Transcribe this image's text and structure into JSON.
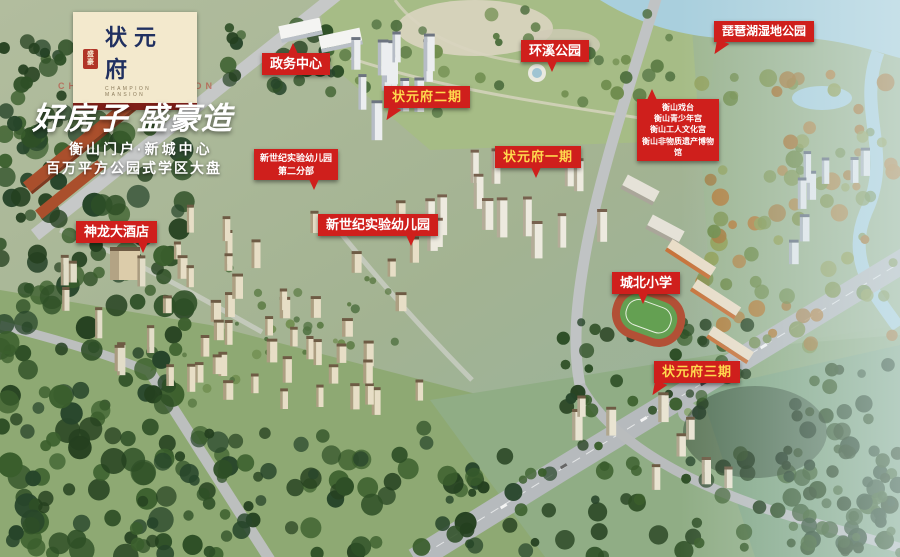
{
  "brand": {
    "seal_text": "盛豪",
    "logo_title": "状元府",
    "logo_subtitle": "CHAMPION MANSION",
    "watermark": "CHAMPION MANSION",
    "headline": "好房子 盛豪造",
    "tagline1": "衡山门户·新城中心",
    "tagline2": "百万平方公园式学区大盘"
  },
  "labels": {
    "government_center": "政务中心",
    "huanxi_park": "环溪公园",
    "pipa_lake_wetland_park": "琵琶湖湿地公园",
    "phase2": "状元府二期",
    "phase1": "状元府一期",
    "culture_line1": "衡山戏台",
    "culture_line2": "衡山青少年宫",
    "culture_line3": "衡山工人文化宫",
    "culture_line4": "衡山非物质遗产博物馆",
    "kindergarten_branch_line1": "新世纪实验幼儿园",
    "kindergarten_branch_line2": "第二分部",
    "kindergarten": "新世纪实验幼儿园",
    "hotel": "神龙大酒店",
    "primary_school": "城北小学",
    "phase3": "状元府三期"
  },
  "colors": {
    "label_red": "#cf1f1c",
    "label_text_white": "#ffffff",
    "label_text_gold": "#ffd84e",
    "logo_background": "#f3e9cd",
    "logo_text_navy": "#203060",
    "logo_bar_darkred": "#7e1f18"
  }
}
